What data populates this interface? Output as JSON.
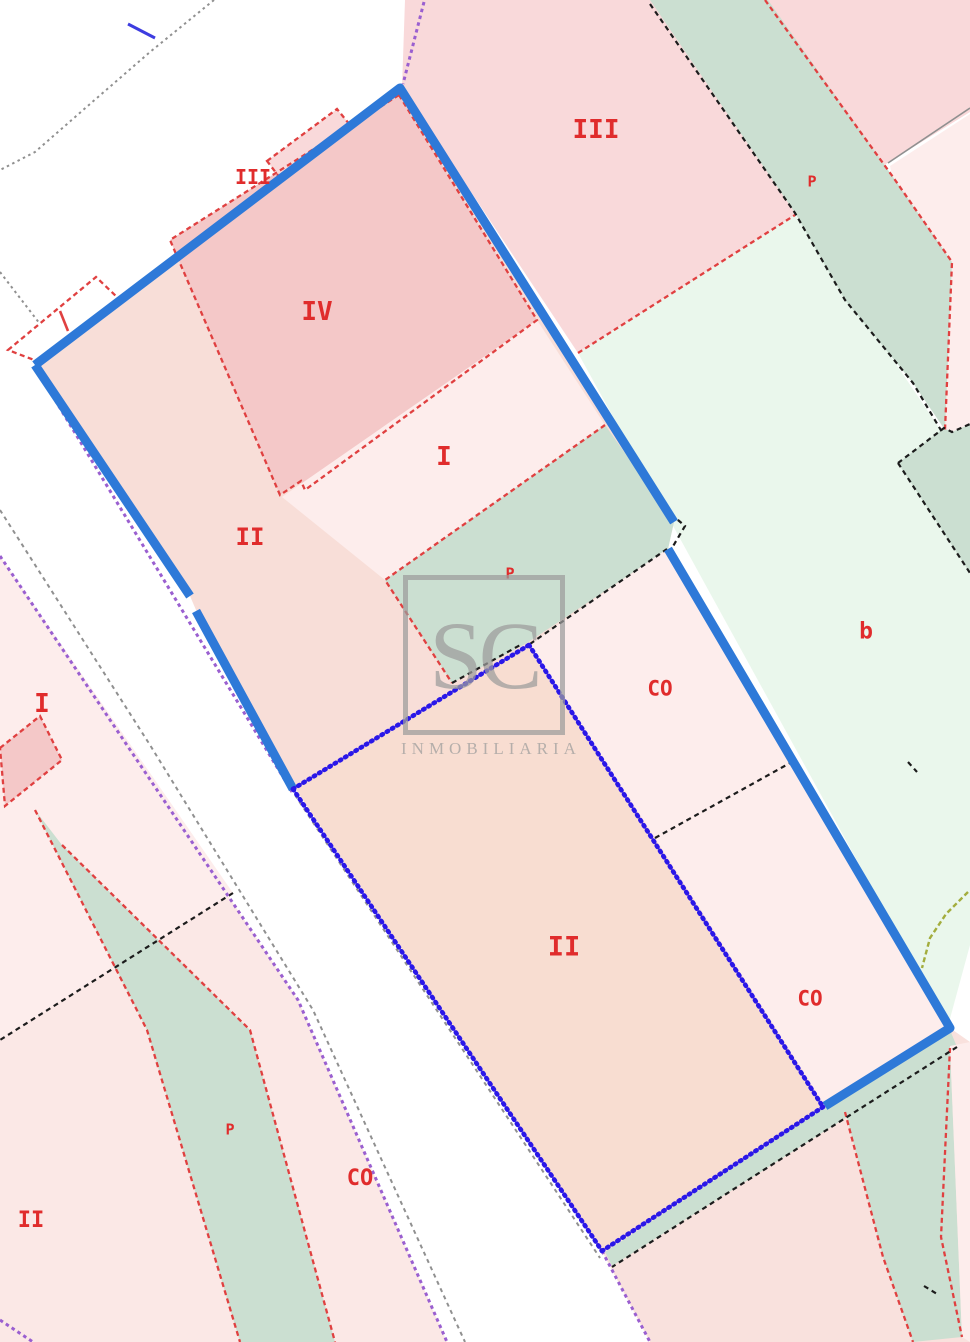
{
  "map": {
    "watermark": {
      "logo": "SC",
      "name": "INMOBILIARIA"
    },
    "labels": [
      {
        "id": "building-iii-small",
        "text": "III",
        "x": 253,
        "y": 177,
        "size": 20
      },
      {
        "id": "building-iv",
        "text": "IV",
        "x": 317,
        "y": 312,
        "size": 26
      },
      {
        "id": "parcel-iii",
        "text": "III",
        "x": 596,
        "y": 130,
        "size": 26
      },
      {
        "id": "path-p-top",
        "text": "P",
        "x": 812,
        "y": 182,
        "size": 15
      },
      {
        "id": "strip-i",
        "text": "I",
        "x": 444,
        "y": 457,
        "size": 26
      },
      {
        "id": "parcel-ii-upper",
        "text": "II",
        "x": 250,
        "y": 537,
        "size": 24
      },
      {
        "id": "strip-p-mid",
        "text": "P",
        "x": 510,
        "y": 574,
        "size": 15
      },
      {
        "id": "parcel-co-upper",
        "text": "CO",
        "x": 660,
        "y": 689,
        "size": 21
      },
      {
        "id": "parcel-b",
        "text": "b",
        "x": 866,
        "y": 632,
        "size": 23
      },
      {
        "id": "parcel-ii-lower",
        "text": "II",
        "x": 564,
        "y": 947,
        "size": 27
      },
      {
        "id": "parcel-co-lower",
        "text": "CO",
        "x": 810,
        "y": 999,
        "size": 21
      },
      {
        "id": "parcel-co-left",
        "text": "CO",
        "x": 360,
        "y": 1179,
        "size": 22
      },
      {
        "id": "strip-p-left",
        "text": "P",
        "x": 230,
        "y": 1130,
        "size": 15
      },
      {
        "id": "parcel-ii-left",
        "text": "II",
        "x": 31,
        "y": 1221,
        "size": 22
      },
      {
        "id": "parcel-i-left",
        "text": "I",
        "x": 42,
        "y": 704,
        "size": 26
      }
    ],
    "colors": {
      "azure_line": "#2e79d8",
      "royal_line": "#2a17e8",
      "purple_line": "#9a5fd0",
      "red_line": "#e04040",
      "red_label": "#e02c2c",
      "black_line": "#1c1c1c",
      "gray_line": "#909090",
      "olive_line": "#a3ad3d",
      "wm_gray": "#9c9c9c",
      "blue_tick": "#3d3ce0",
      "fill_left_base": "#fbe8e6",
      "fill_pale_pink": "#fdedec",
      "fill_dark_pink": "#f4c8c8",
      "fill_pink_tr": "#f9d9da",
      "fill_mint": "#eaf7ec",
      "fill_sage": "#cbdfd1",
      "fill_sel_upper": "#f8ded8",
      "fill_sel_lower": "#f8ddd1",
      "fill_pink_bottom": "#f9e1dd",
      "fill_road": "#ffffff"
    }
  }
}
